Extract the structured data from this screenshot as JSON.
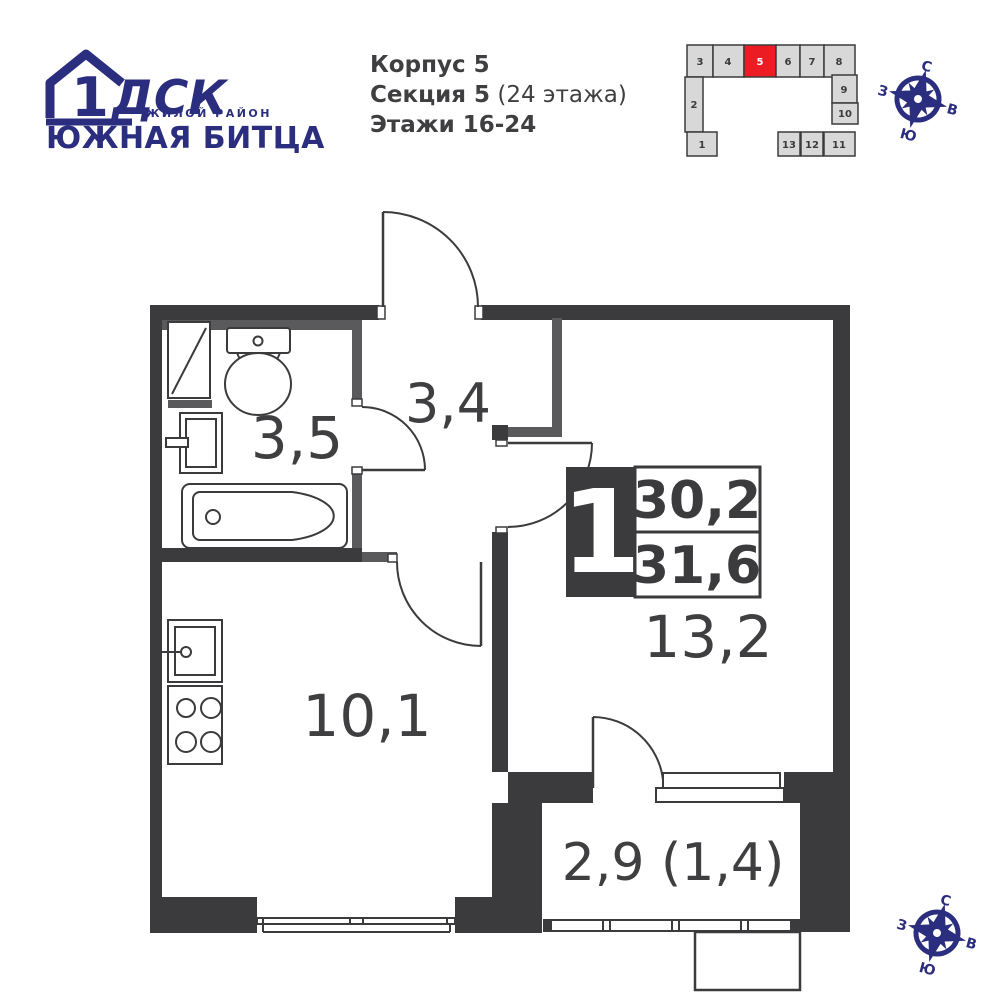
{
  "logo": {
    "one": "1",
    "dsk": "ДСК",
    "tagline": "ЖИЛОЙ РАЙОН",
    "district": "ЮЖНАЯ БИТЦА"
  },
  "header": {
    "building": "Корпус 5",
    "section": "Секция 5",
    "section_note": " (24 этажа)",
    "floors": "Этажи 16-24"
  },
  "building_map": {
    "highlighted": "5",
    "highlight_color": "#ec1c24",
    "numbers": [
      "1",
      "2",
      "3",
      "4",
      "5",
      "6",
      "7",
      "8",
      "9",
      "10",
      "11",
      "12",
      "13"
    ]
  },
  "apartment": {
    "rooms_badge": "1",
    "area_living": "30,2",
    "area_total": "31,6"
  },
  "plan": {
    "labels": {
      "bathroom": "3,5",
      "hall": "3,4",
      "kitchen": "10,1",
      "room": "13,2",
      "balcony": "2,9 (1,4)"
    }
  },
  "compass": {
    "n": "С",
    "e": "В",
    "s": "Ю",
    "w": "З"
  },
  "colors": {
    "wall": "#3b3b3d",
    "wall_light": "#5a5a5c",
    "text": "#3f3f41",
    "navy": "#2b2e7e",
    "red": "#ec1c24",
    "map_block": "#d8d8d9"
  }
}
